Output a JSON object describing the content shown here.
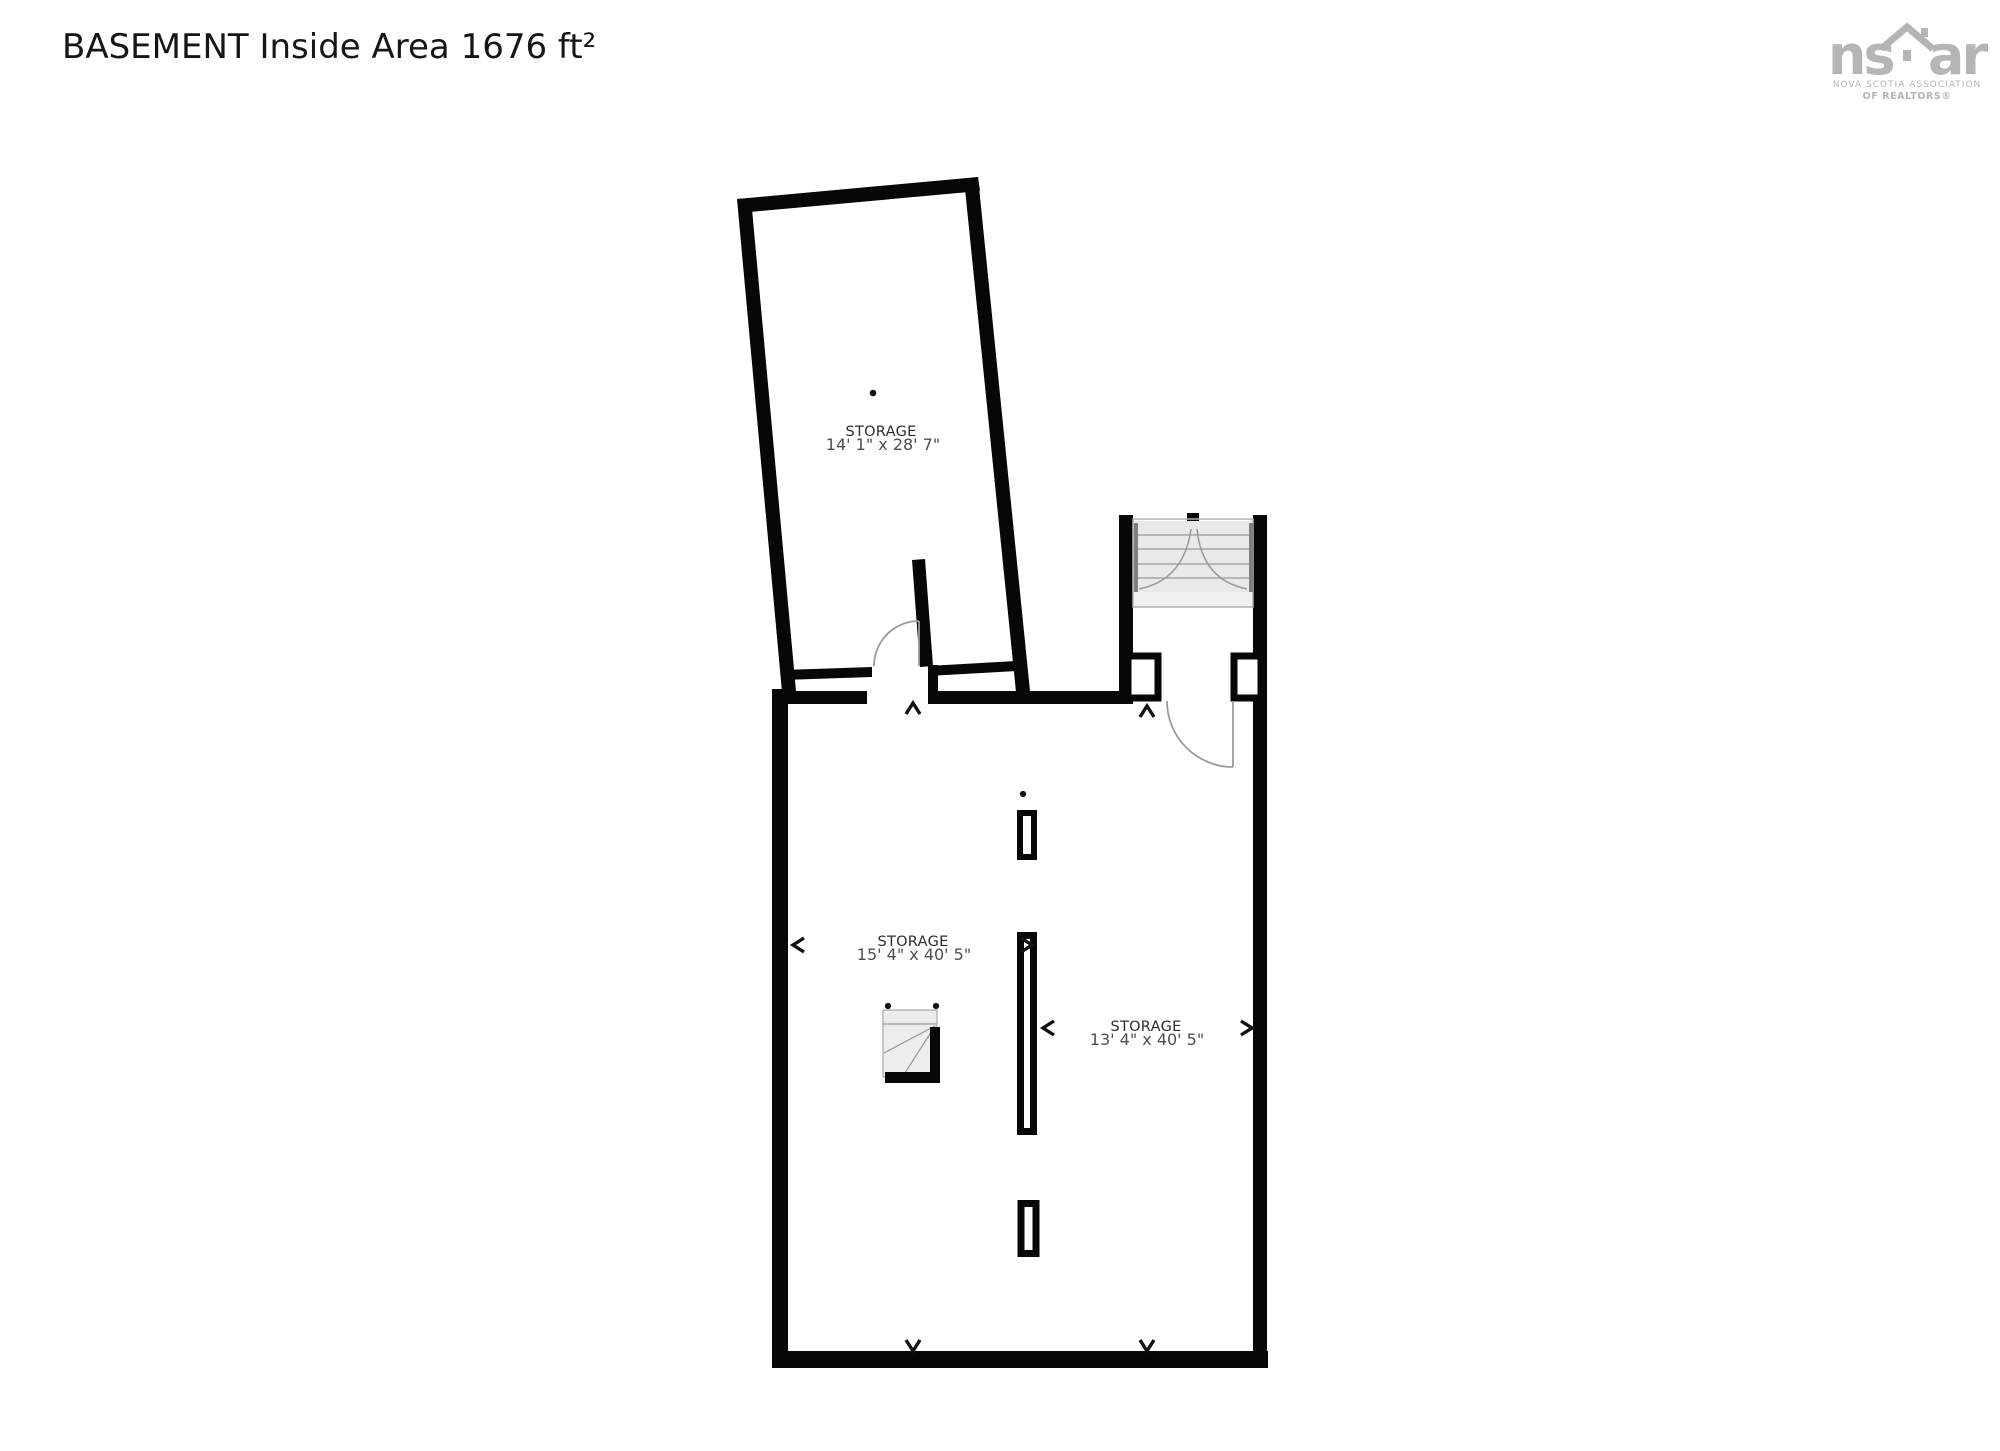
{
  "header": {
    "title": "BASEMENT Inside Area 1676 ft²"
  },
  "logo": {
    "mark_left": "ns",
    "mark_right": "ar",
    "line1": "NOVA SCOTIA ASSOCIATION",
    "line2": "OF REALTORS®"
  },
  "rooms": [
    {
      "id": "storage-upper",
      "name": "STORAGE",
      "dims": "14' 1\" x 28' 7\""
    },
    {
      "id": "storage-left",
      "name": "STORAGE",
      "dims": "15' 4\" x 40' 5\""
    },
    {
      "id": "storage-right",
      "name": "STORAGE",
      "dims": "13' 4\" x 40' 5\""
    }
  ],
  "colors": {
    "wall": "#070707",
    "door_arc": "#9b9b9b",
    "tread_fill": "#e9e9e9",
    "tread_line": "#a6a6a6",
    "rail": "#7f7f7f",
    "landing_fill": "#f1f1f1",
    "icon_fill": "#ededed",
    "icon_line": "#999999",
    "label": "#2d2d2d",
    "dims": "#4e4e4e",
    "logo_gray": "#b5b5b5",
    "title_color": "#161616"
  }
}
